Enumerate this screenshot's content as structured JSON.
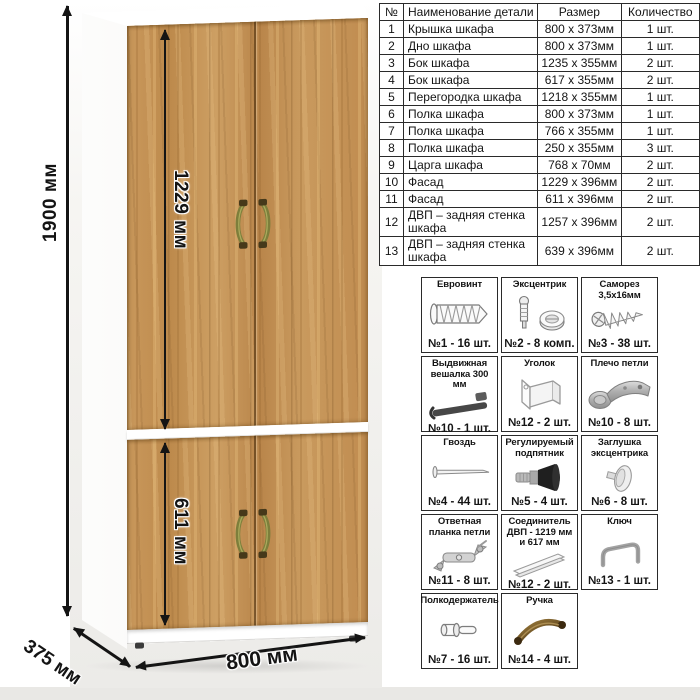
{
  "dimensions": {
    "height_label": "1900 мм",
    "upper_door_label": "1229 мм",
    "lower_door_label": "611 мм",
    "depth_label": "375 мм",
    "width_label": "800 мм"
  },
  "parts_table": {
    "headers": {
      "num": "№",
      "name": "Наименование детали",
      "size": "Размер",
      "qty": "Количество"
    },
    "rows": [
      {
        "num": "1",
        "name": "Крышка шкафа",
        "size": "800 x 373мм",
        "qty": "1 шт."
      },
      {
        "num": "2",
        "name": "Дно шкафа",
        "size": "800 x 373мм",
        "qty": "1 шт."
      },
      {
        "num": "3",
        "name": "Бок шкафа",
        "size": "1235 x 355мм",
        "qty": "2 шт."
      },
      {
        "num": "4",
        "name": "Бок шкафа",
        "size": "617 x 355мм",
        "qty": "2 шт."
      },
      {
        "num": "5",
        "name": "Перегородка шкафа",
        "size": "1218 x 355мм",
        "qty": "1 шт."
      },
      {
        "num": "6",
        "name": "Полка шкафа",
        "size": "800 x 373мм",
        "qty": "1 шт."
      },
      {
        "num": "7",
        "name": "Полка шкафа",
        "size": "766 x 355мм",
        "qty": "1 шт."
      },
      {
        "num": "8",
        "name": "Полка шкафа",
        "size": "250 x 355мм",
        "qty": "3 шт."
      },
      {
        "num": "9",
        "name": "Царга шкафа",
        "size": "768 x 70мм",
        "qty": "2 шт."
      },
      {
        "num": "10",
        "name": "Фасад",
        "size": "1229 x 396мм",
        "qty": "2 шт."
      },
      {
        "num": "11",
        "name": "Фасад",
        "size": "611 x 396мм",
        "qty": "2 шт."
      },
      {
        "num": "12",
        "name": "ДВП – задняя стенка шкафа",
        "size": "1257 x 396мм",
        "qty": "2 шт."
      },
      {
        "num": "13",
        "name": "ДВП – задняя стенка шкафа",
        "size": "639 x 396мм",
        "qty": "2 шт."
      }
    ]
  },
  "hardware": {
    "items": [
      {
        "title": "Евровинт",
        "count": "№1 - 16 шт.",
        "icon": "euro-screw-icon"
      },
      {
        "title": "Эксцентрик",
        "count": "№2 - 8 комп.",
        "icon": "cam-lock-icon"
      },
      {
        "title": "Саморез 3,5х16мм",
        "count": "№3 - 38 шт.",
        "icon": "self-tapping-screw-icon"
      },
      {
        "title": "Выдвижная вешалка 300 мм",
        "count": "№10 - 1 шт.",
        "icon": "pull-out-hanger-icon"
      },
      {
        "title": "Уголок",
        "count": "№12 - 2 шт.",
        "icon": "corner-bracket-icon"
      },
      {
        "title": "Плечо петли",
        "count": "№10 - 8 шт.",
        "icon": "hinge-arm-icon"
      },
      {
        "title": "Гвоздь",
        "count": "№4 - 44 шт.",
        "icon": "nail-icon"
      },
      {
        "title": "Регулируемый подпятник",
        "count": "№5 - 4 шт.",
        "icon": "adjustable-foot-icon"
      },
      {
        "title": "Заглушка эксцентрика",
        "count": "№6 - 8 шт.",
        "icon": "cam-cap-icon"
      },
      {
        "title": "Ответная планка петли",
        "count": "№11 - 8 шт.",
        "icon": "hinge-plate-icon"
      },
      {
        "title": "Соединитель ДВП - 1219 мм и 617 мм",
        "count": "№12 - 2 шт.",
        "icon": "hdf-connector-icon"
      },
      {
        "title": "Ключ",
        "count": "№13 - 1 шт.",
        "icon": "hex-key-icon"
      },
      {
        "title": "Полкодержатель",
        "count": "№7 - 16 шт.",
        "icon": "shelf-pin-icon"
      },
      {
        "title": "Ручка",
        "count": "№14 - 4 шт.",
        "icon": "handle-icon"
      }
    ]
  },
  "colors": {
    "wood": "#c59357",
    "carcass_white": "#ffffff",
    "handle_bronze": "#7d7e3b",
    "line_black": "#141414"
  }
}
